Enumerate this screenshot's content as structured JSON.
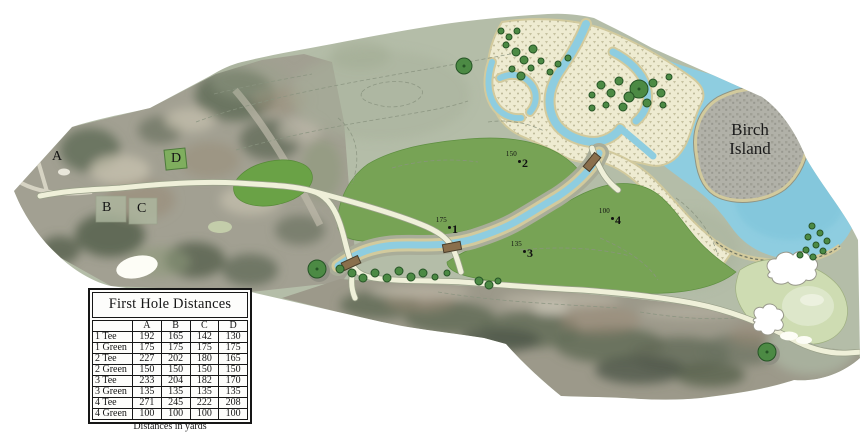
{
  "map": {
    "region_labels": [
      {
        "id": "A",
        "text": "A"
      },
      {
        "id": "B",
        "text": "B"
      },
      {
        "id": "C",
        "text": "C"
      },
      {
        "id": "D",
        "text": "D"
      }
    ],
    "island": {
      "line1": "Birch",
      "line2": "Island"
    },
    "markers": [
      {
        "number": "1",
        "distance": "175"
      },
      {
        "number": "2",
        "distance": "150"
      },
      {
        "number": "3",
        "distance": "135"
      },
      {
        "number": "4",
        "distance": "100"
      }
    ]
  },
  "table": {
    "title": "First Hole Distances",
    "columns": [
      "",
      "A",
      "B",
      "C",
      "D"
    ],
    "rows": [
      {
        "label": "1 Tee",
        "values": [
          "192",
          "165",
          "142",
          "130"
        ]
      },
      {
        "label": "1 Green",
        "values": [
          "175",
          "175",
          "175",
          "175"
        ]
      },
      {
        "label": "2 Tee",
        "values": [
          "227",
          "202",
          "180",
          "165"
        ]
      },
      {
        "label": "2 Green",
        "values": [
          "150",
          "150",
          "150",
          "150"
        ]
      },
      {
        "label": "3 Tee",
        "values": [
          "233",
          "204",
          "182",
          "170"
        ]
      },
      {
        "label": "3 Green",
        "values": [
          "135",
          "135",
          "135",
          "135"
        ]
      },
      {
        "label": "4 Tee",
        "values": [
          "271",
          "245",
          "222",
          "208"
        ]
      },
      {
        "label": "4 Green",
        "values": [
          "100",
          "100",
          "100",
          "100"
        ]
      }
    ],
    "caption": "Distances in yards"
  },
  "colors": {
    "sage": "#b4bda8",
    "fairway": "#77a355",
    "fairwayDark": "#6aa246",
    "apron": "#cedcb2",
    "water": "#8ecde0",
    "marsh": "#eeebd1",
    "sand": "#d2ca9d",
    "path": "#eff0d9",
    "tree": "#4c8a44",
    "island": "#b1b1a8",
    "bridge": "#8a6f4c",
    "ink": "#161616"
  }
}
